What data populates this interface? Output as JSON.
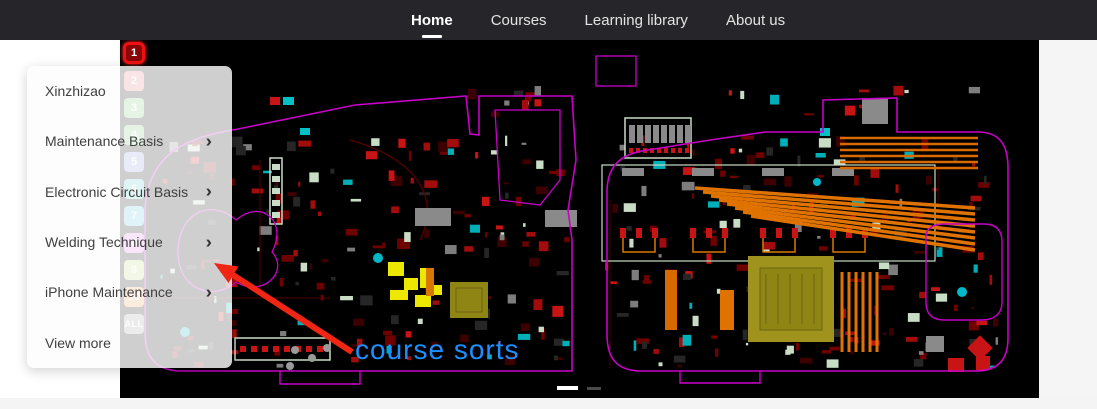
{
  "nav": {
    "items": [
      {
        "label": "Home",
        "active": true
      },
      {
        "label": "Courses",
        "active": false
      },
      {
        "label": "Learning library",
        "active": false
      },
      {
        "label": "About us",
        "active": false
      }
    ]
  },
  "menu": {
    "items": [
      {
        "label": "Xinzhizao",
        "has_submenu": false
      },
      {
        "label": "Maintenance Basis",
        "has_submenu": true
      },
      {
        "label": "Electronic Circuit Basis",
        "has_submenu": true
      },
      {
        "label": "Welding Technique",
        "has_submenu": true
      },
      {
        "label": "iPhone Maintenance",
        "has_submenu": true
      },
      {
        "label": "View more",
        "has_submenu": false
      }
    ],
    "submenu_arrow": "›"
  },
  "slide_strip": {
    "items": [
      {
        "label": "1",
        "color": "#8a0606",
        "active": true
      },
      {
        "label": "2",
        "color": "#e87c7c",
        "active": false
      },
      {
        "label": "3",
        "color": "#7ccc7c",
        "active": false
      },
      {
        "label": "4",
        "color": "#7ccc7c",
        "active": false
      },
      {
        "label": "5",
        "color": "#8c9ae0",
        "active": false
      },
      {
        "label": "6",
        "color": "#5ad2d2",
        "active": false
      },
      {
        "label": "7",
        "color": "#5ac8e6",
        "active": false
      },
      {
        "label": "8",
        "color": "#ee82ee",
        "active": false
      },
      {
        "label": "9",
        "color": "#c8dc78",
        "active": false
      },
      {
        "label": "10",
        "color": "#f0a050",
        "active": false
      },
      {
        "label": "ALL",
        "color": "#9e9e9e",
        "active": false
      }
    ]
  },
  "annotation": {
    "text": "course sorts",
    "text_color": "#1e8fff",
    "arrow_color": "#f02513"
  },
  "carousel": {
    "active_color": "#ffffff",
    "inactive_color": "#4a4a4a"
  },
  "colors": {
    "navbar_bg": "#26262a",
    "nav_active_text": "#ffffff",
    "hero_bg": "#000000",
    "board_outline": "#c800c8",
    "menu_text": "#3f3f3f",
    "page_bg": "#ffffff"
  }
}
